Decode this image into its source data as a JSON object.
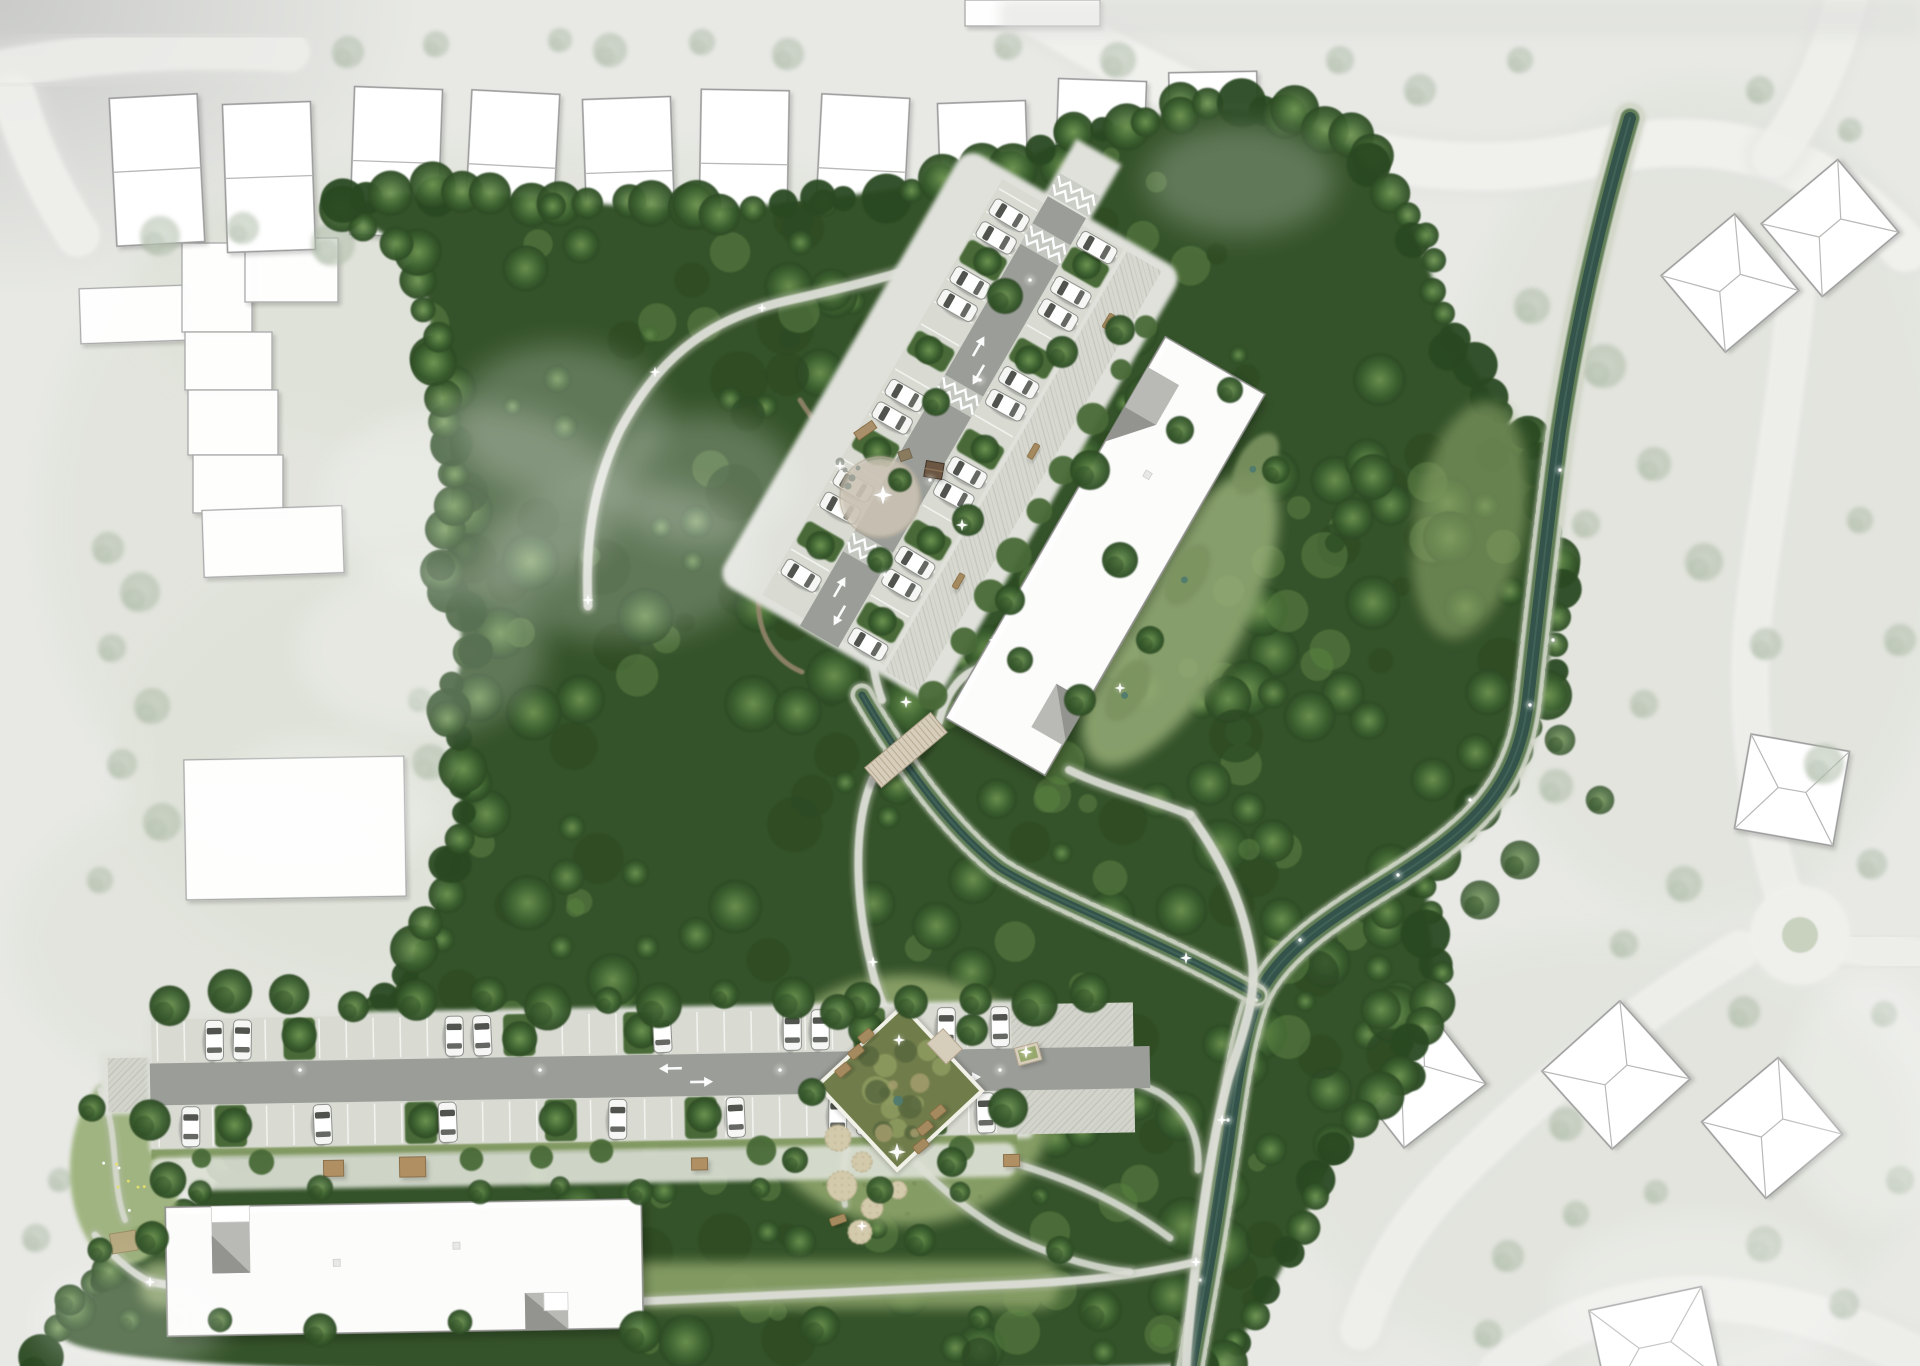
{
  "canvas": {
    "width": 1920,
    "height": 1366
  },
  "palette": {
    "bg": "#e7e9e3",
    "bg_outer": "#e9e9e7",
    "corner_shade": "#c7c8c6",
    "road_ctx": "#f0f0ed",
    "road_under": "#e2e3e0",
    "bldg_white": "#fcfcfb",
    "bldg_outline": "#8e8e8c",
    "roof_line": "#b8b8b6",
    "notch_gray": "#b9bab6",
    "notch_dark": "#93948f",
    "pave_light": "#d9dbd3",
    "pave_aisle": "#9b9d98",
    "pave_walk": "#d7d9d1",
    "stall_line": "#f2f3ef",
    "hedge": "#4a6a38",
    "tree_dark": "#2c4a24",
    "tree_mid": "#3d6130",
    "tree_light": "#5b8243",
    "tree_hi": "#6f9552",
    "tree_faded": "#aab8a4",
    "forest_base": "#365229",
    "meadow": "#8ba269",
    "meadow_light": "#9cb27b",
    "water": "#33534b",
    "water_hi": "#4a6f63",
    "moss": "#54744c",
    "bank": "#c6cdbb",
    "dirt": "#998870",
    "deck_wood": "#d7cdbb",
    "bench_wood": "#a5895f",
    "shed_wood": "#b08f63",
    "pond_base": "#707d4b",
    "pond_light": "#8e9b60",
    "pond_dark": "#57663c",
    "sand": "#d3c9ab",
    "sand_edge": "#b9ad8c",
    "car_body": "#f6f7f4",
    "car_glass": "#41443f",
    "white": "#ffffff"
  },
  "scene": {
    "type": "landscape masterplan rendering, top view",
    "context": {
      "gable_house_count": 10,
      "hip_house_count": 7,
      "flat_building_count": 10,
      "roads": [
        "left vertical street",
        "top-right curved street",
        "cul-de-sac loop",
        "south-east lane"
      ]
    },
    "site": {
      "north_cluster": {
        "label": "north slab building with diagonal parking court",
        "car_count": 19,
        "zigzag_crossings": 4,
        "two_way_arrows": 2
      },
      "south_cluster": {
        "label": "south slab building with parking lane",
        "car_count": 17,
        "two_way_arrow_pairs": 2
      },
      "water": {
        "stream": "rocky-bank stream through forest with confluence",
        "creek": "creek branch crossed by timber bridge"
      },
      "amenities": [
        "timber plank bridge",
        "community garden pond square",
        "play mounds",
        "forest plaza with cabin",
        "stair path",
        "benches",
        "garden sheds",
        "lamps"
      ]
    },
    "vegetation": {
      "forest": "dense woodland mass",
      "meadow_patches": 5,
      "faded_context_trees": true
    }
  }
}
